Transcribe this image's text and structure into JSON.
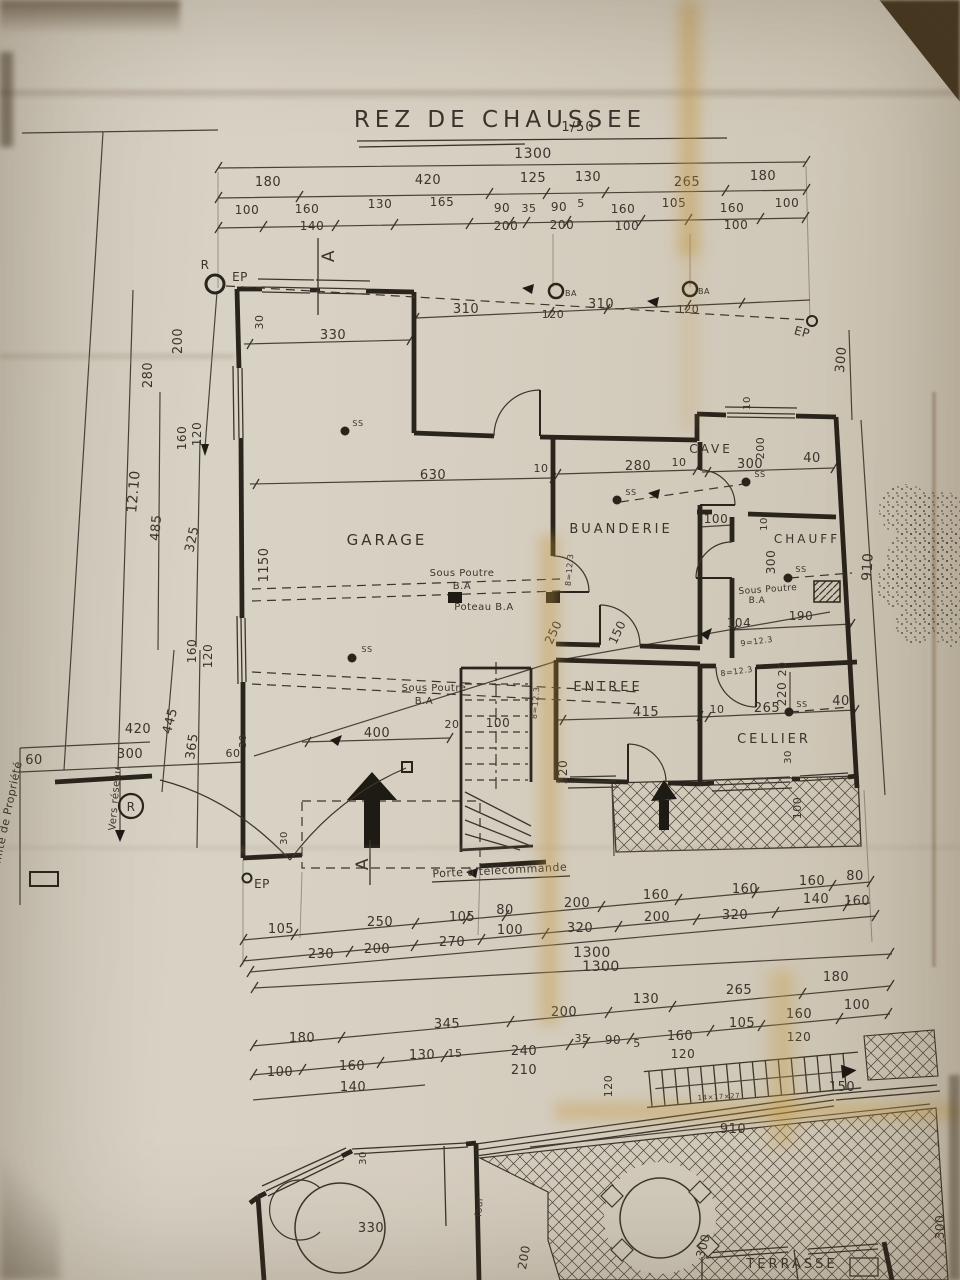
{
  "title": {
    "text": "REZ DE CHAUSSEE",
    "scale": "1/50"
  },
  "floor_plan": {
    "rooms": [
      {
        "t": "GARAGE",
        "x": 387,
        "y": 545,
        "s": 15
      },
      {
        "t": "BUANDERIE",
        "x": 621,
        "y": 533,
        "s": 13
      },
      {
        "t": "CAVE",
        "x": 711,
        "y": 453,
        "s": 12
      },
      {
        "t": "CHAUFF",
        "x": 807,
        "y": 543,
        "s": 12
      },
      {
        "t": "ENTREE",
        "x": 608,
        "y": 691,
        "s": 13
      },
      {
        "t": "CELLIER",
        "x": 774,
        "y": 743,
        "s": 13
      },
      {
        "t": "TERRASSE",
        "x": 792,
        "y": 1268,
        "s": 13
      }
    ],
    "dims": [
      {
        "t": "1300",
        "x": 533,
        "y": 158,
        "s": 14
      },
      {
        "t": "180",
        "x": 268,
        "y": 186
      },
      {
        "t": "420",
        "x": 428,
        "y": 184
      },
      {
        "t": "125",
        "x": 533,
        "y": 182
      },
      {
        "t": "130",
        "x": 588,
        "y": 181
      },
      {
        "t": "265",
        "x": 687,
        "y": 186
      },
      {
        "t": "180",
        "x": 763,
        "y": 180
      },
      {
        "t": "100",
        "x": 247,
        "y": 214,
        "s": 12
      },
      {
        "t": "160",
        "x": 307,
        "y": 213,
        "s": 12
      },
      {
        "t": "140",
        "x": 312,
        "y": 230,
        "s": 12
      },
      {
        "t": "130",
        "x": 380,
        "y": 208,
        "s": 12
      },
      {
        "t": "165",
        "x": 442,
        "y": 206,
        "s": 12
      },
      {
        "t": "90",
        "x": 502,
        "y": 212,
        "s": 12
      },
      {
        "t": "200",
        "x": 506,
        "y": 230,
        "s": 12
      },
      {
        "t": "35",
        "x": 529,
        "y": 212,
        "s": 11
      },
      {
        "t": "90",
        "x": 559,
        "y": 211,
        "s": 12
      },
      {
        "t": "200",
        "x": 562,
        "y": 229,
        "s": 12
      },
      {
        "t": "5",
        "x": 581,
        "y": 207,
        "s": 11
      },
      {
        "t": "160",
        "x": 623,
        "y": 213,
        "s": 12
      },
      {
        "t": "100",
        "x": 627,
        "y": 230,
        "s": 12
      },
      {
        "t": "105",
        "x": 674,
        "y": 207,
        "s": 12
      },
      {
        "t": "160",
        "x": 732,
        "y": 212,
        "s": 12
      },
      {
        "t": "100",
        "x": 736,
        "y": 229,
        "s": 12
      },
      {
        "t": "100",
        "x": 787,
        "y": 207,
        "s": 12
      },
      {
        "t": "280",
        "x": 152,
        "y": 375,
        "r": -90
      },
      {
        "t": "200",
        "x": 182,
        "y": 341,
        "r": -90
      },
      {
        "t": "160",
        "x": 186,
        "y": 438,
        "r": -90,
        "s": 12
      },
      {
        "t": "120",
        "x": 201,
        "y": 434,
        "r": -90,
        "s": 12
      },
      {
        "t": "485",
        "x": 160,
        "y": 528,
        "r": -85
      },
      {
        "t": "325",
        "x": 196,
        "y": 540,
        "r": -78
      },
      {
        "t": "12.10",
        "x": 138,
        "y": 492,
        "r": -85,
        "s": 14
      },
      {
        "t": "160",
        "x": 196,
        "y": 651,
        "r": -90,
        "s": 12
      },
      {
        "t": "120",
        "x": 212,
        "y": 656,
        "r": -90,
        "s": 12
      },
      {
        "t": "445",
        "x": 174,
        "y": 722,
        "r": -75
      },
      {
        "t": "365",
        "x": 196,
        "y": 747,
        "r": -82
      },
      {
        "t": "420",
        "x": 138,
        "y": 733
      },
      {
        "t": "300",
        "x": 130,
        "y": 758
      },
      {
        "t": "60",
        "x": 34,
        "y": 764
      },
      {
        "t": "60",
        "x": 233,
        "y": 757,
        "s": 11
      },
      {
        "t": "30",
        "x": 246,
        "y": 741,
        "r": -90,
        "s": 10
      },
      {
        "t": "30",
        "x": 263,
        "y": 322,
        "r": -90,
        "s": 11
      },
      {
        "t": "330",
        "x": 333,
        "y": 339
      },
      {
        "t": "310",
        "x": 466,
        "y": 313
      },
      {
        "t": "120",
        "x": 553,
        "y": 318,
        "s": 11
      },
      {
        "t": "310",
        "x": 601,
        "y": 308
      },
      {
        "t": "120",
        "x": 688,
        "y": 313,
        "s": 11
      },
      {
        "t": "300",
        "x": 845,
        "y": 360,
        "r": -85
      },
      {
        "t": "910",
        "x": 872,
        "y": 567,
        "r": -87,
        "s": 14
      },
      {
        "t": "1150",
        "x": 268,
        "y": 565,
        "r": -90
      },
      {
        "t": "30",
        "x": 287,
        "y": 838,
        "r": -90,
        "s": 10
      },
      {
        "t": "630",
        "x": 433,
        "y": 479
      },
      {
        "t": "10",
        "x": 541,
        "y": 472,
        "s": 11
      },
      {
        "t": "280",
        "x": 638,
        "y": 470
      },
      {
        "t": "10",
        "x": 679,
        "y": 466,
        "s": 11
      },
      {
        "t": "300",
        "x": 750,
        "y": 468
      },
      {
        "t": "200",
        "x": 764,
        "y": 448,
        "r": -90,
        "s": 11
      },
      {
        "t": "40",
        "x": 812,
        "y": 462
      },
      {
        "t": "10",
        "x": 750,
        "y": 403,
        "r": -90,
        "s": 10
      },
      {
        "t": "100",
        "x": 716,
        "y": 523,
        "s": 12
      },
      {
        "t": "10",
        "x": 767,
        "y": 524,
        "r": -90,
        "s": 10
      },
      {
        "t": "300",
        "x": 775,
        "y": 562,
        "r": -90,
        "s": 12
      },
      {
        "t": "190",
        "x": 801,
        "y": 620,
        "s": 12
      },
      {
        "t": "104",
        "x": 739,
        "y": 627,
        "s": 12
      },
      {
        "t": "250",
        "x": 557,
        "y": 634,
        "r": -65,
        "s": 12
      },
      {
        "t": "150",
        "x": 621,
        "y": 634,
        "r": -65,
        "s": 12
      },
      {
        "t": "415",
        "x": 646,
        "y": 716
      },
      {
        "t": "10",
        "x": 717,
        "y": 713,
        "s": 11
      },
      {
        "t": "265",
        "x": 767,
        "y": 712
      },
      {
        "t": "40",
        "x": 841,
        "y": 705
      },
      {
        "t": "20",
        "x": 786,
        "y": 669,
        "r": -90,
        "s": 11
      },
      {
        "t": "220",
        "x": 786,
        "y": 694,
        "r": -90,
        "s": 12
      },
      {
        "t": "20",
        "x": 452,
        "y": 728,
        "s": 11
      },
      {
        "t": "100",
        "x": 498,
        "y": 727,
        "s": 12
      },
      {
        "t": "400",
        "x": 377,
        "y": 737
      },
      {
        "t": "320",
        "x": 567,
        "y": 772,
        "r": -90,
        "s": 12
      },
      {
        "t": "30",
        "x": 791,
        "y": 757,
        "r": -90,
        "s": 10
      },
      {
        "t": "100",
        "x": 801,
        "y": 808,
        "r": -90,
        "s": 11
      },
      {
        "t": "105",
        "x": 281,
        "y": 933
      },
      {
        "t": "250",
        "x": 380,
        "y": 926
      },
      {
        "t": "105",
        "x": 462,
        "y": 921
      },
      {
        "t": "80",
        "x": 505,
        "y": 914
      },
      {
        "t": "200",
        "x": 577,
        "y": 907
      },
      {
        "t": "160",
        "x": 656,
        "y": 899
      },
      {
        "t": "160",
        "x": 745,
        "y": 893
      },
      {
        "t": "160",
        "x": 812,
        "y": 885
      },
      {
        "t": "80",
        "x": 855,
        "y": 880
      },
      {
        "t": "230",
        "x": 321,
        "y": 958
      },
      {
        "t": "200",
        "x": 377,
        "y": 953
      },
      {
        "t": "270",
        "x": 452,
        "y": 946
      },
      {
        "t": "100",
        "x": 510,
        "y": 934
      },
      {
        "t": "320",
        "x": 580,
        "y": 932
      },
      {
        "t": "200",
        "x": 657,
        "y": 921
      },
      {
        "t": "320",
        "x": 735,
        "y": 919
      },
      {
        "t": "140",
        "x": 816,
        "y": 903
      },
      {
        "t": "160",
        "x": 857,
        "y": 905
      },
      {
        "t": "1300",
        "x": 592,
        "y": 957,
        "s": 14
      },
      {
        "t": "1300",
        "x": 601,
        "y": 971,
        "s": 14
      },
      {
        "t": "180",
        "x": 836,
        "y": 981
      },
      {
        "t": "265",
        "x": 739,
        "y": 994
      },
      {
        "t": "130",
        "x": 646,
        "y": 1003
      },
      {
        "t": "200",
        "x": 564,
        "y": 1016
      },
      {
        "t": "345",
        "x": 447,
        "y": 1028
      },
      {
        "t": "100",
        "x": 857,
        "y": 1009
      },
      {
        "t": "160",
        "x": 799,
        "y": 1018
      },
      {
        "t": "105",
        "x": 742,
        "y": 1027
      },
      {
        "t": "160",
        "x": 680,
        "y": 1040
      },
      {
        "t": "120",
        "x": 799,
        "y": 1041,
        "s": 12
      },
      {
        "t": "35",
        "x": 582,
        "y": 1042,
        "s": 11
      },
      {
        "t": "90",
        "x": 613,
        "y": 1044,
        "s": 12
      },
      {
        "t": "5",
        "x": 637,
        "y": 1047,
        "s": 11
      },
      {
        "t": "240",
        "x": 524,
        "y": 1055
      },
      {
        "t": "210",
        "x": 524,
        "y": 1074
      },
      {
        "t": "130",
        "x": 422,
        "y": 1059
      },
      {
        "t": "15",
        "x": 455,
        "y": 1057,
        "s": 11
      },
      {
        "t": "180",
        "x": 302,
        "y": 1042
      },
      {
        "t": "100",
        "x": 280,
        "y": 1076
      },
      {
        "t": "160",
        "x": 352,
        "y": 1070
      },
      {
        "t": "140",
        "x": 353,
        "y": 1091
      },
      {
        "t": "120",
        "x": 683,
        "y": 1058,
        "s": 12
      },
      {
        "t": "150",
        "x": 842,
        "y": 1091
      },
      {
        "t": "120",
        "x": 612,
        "y": 1086,
        "r": -90,
        "s": 11
      },
      {
        "t": "910",
        "x": 733,
        "y": 1133
      },
      {
        "t": "330",
        "x": 371,
        "y": 1232
      },
      {
        "t": "30",
        "x": 366,
        "y": 1158,
        "r": -90,
        "s": 10
      },
      {
        "t": "200",
        "x": 528,
        "y": 1258,
        "r": -80,
        "s": 12
      },
      {
        "t": "300",
        "x": 707,
        "y": 1247,
        "r": -75,
        "s": 12
      },
      {
        "t": "300",
        "x": 944,
        "y": 1227,
        "r": -90,
        "s": 12
      }
    ],
    "annotations": [
      {
        "t": "Sous Poutre",
        "x": 462,
        "y": 576,
        "s": 10
      },
      {
        "t": "B.A",
        "x": 462,
        "y": 589,
        "s": 10
      },
      {
        "t": "Poteau B.A",
        "x": 484,
        "y": 610,
        "s": 10
      },
      {
        "t": "Sous Poutre",
        "x": 434,
        "y": 691,
        "s": 10
      },
      {
        "t": "B.A",
        "x": 424,
        "y": 704,
        "s": 10
      },
      {
        "t": "Sous Poutre",
        "x": 768,
        "y": 592,
        "r": -4,
        "s": 9
      },
      {
        "t": "B.A",
        "x": 757,
        "y": 603,
        "s": 9
      },
      {
        "t": "Porte à télécommande",
        "x": 500,
        "y": 874,
        "r": -3,
        "s": 11
      },
      {
        "t": "Vers réseau",
        "x": 118,
        "y": 799,
        "r": -85,
        "s": 10
      },
      {
        "t": "Limite de Propriété",
        "x": 10,
        "y": 818,
        "r": -78,
        "s": 11
      },
      {
        "t": "9=12.3",
        "x": 757,
        "y": 644,
        "r": -8,
        "s": 8
      },
      {
        "t": "8=12.3",
        "x": 737,
        "y": 674,
        "r": -8,
        "s": 8
      },
      {
        "t": "8=12.3",
        "x": 538,
        "y": 703,
        "r": -85,
        "s": 8
      },
      {
        "t": "8=12.3",
        "x": 572,
        "y": 570,
        "r": -85,
        "s": 8
      },
      {
        "t": "14×17×27",
        "x": 719,
        "y": 1099,
        "r": -3,
        "s": 7
      },
      {
        "t": "four",
        "x": 482,
        "y": 1207,
        "r": -85,
        "s": 9
      }
    ],
    "markers": [
      {
        "t": "R",
        "x": 205,
        "y": 269,
        "s": 12
      },
      {
        "t": "EP",
        "x": 240,
        "y": 281,
        "s": 12
      },
      {
        "t": "EP",
        "x": 801,
        "y": 336,
        "r": 15,
        "s": 12
      },
      {
        "t": "EP",
        "x": 262,
        "y": 888,
        "s": 12
      },
      {
        "t": "R",
        "x": 131,
        "y": 811,
        "s": 12
      },
      {
        "t": "A",
        "x": 334,
        "y": 256,
        "r": -90,
        "s": 17
      },
      {
        "t": "A",
        "x": 368,
        "y": 864,
        "r": -90,
        "s": 17
      },
      {
        "t": "BA",
        "x": 571,
        "y": 296,
        "s": 8
      },
      {
        "t": "BA",
        "x": 704,
        "y": 294,
        "s": 8
      },
      {
        "t": "SS",
        "x": 358,
        "y": 426,
        "s": 8
      },
      {
        "t": "SS",
        "x": 367,
        "y": 652,
        "s": 8
      },
      {
        "t": "SS",
        "x": 631,
        "y": 495,
        "s": 8
      },
      {
        "t": "SS",
        "x": 760,
        "y": 477,
        "s": 8
      },
      {
        "t": "SS",
        "x": 801,
        "y": 572,
        "s": 8
      },
      {
        "t": "SS",
        "x": 802,
        "y": 707,
        "s": 8
      }
    ]
  }
}
